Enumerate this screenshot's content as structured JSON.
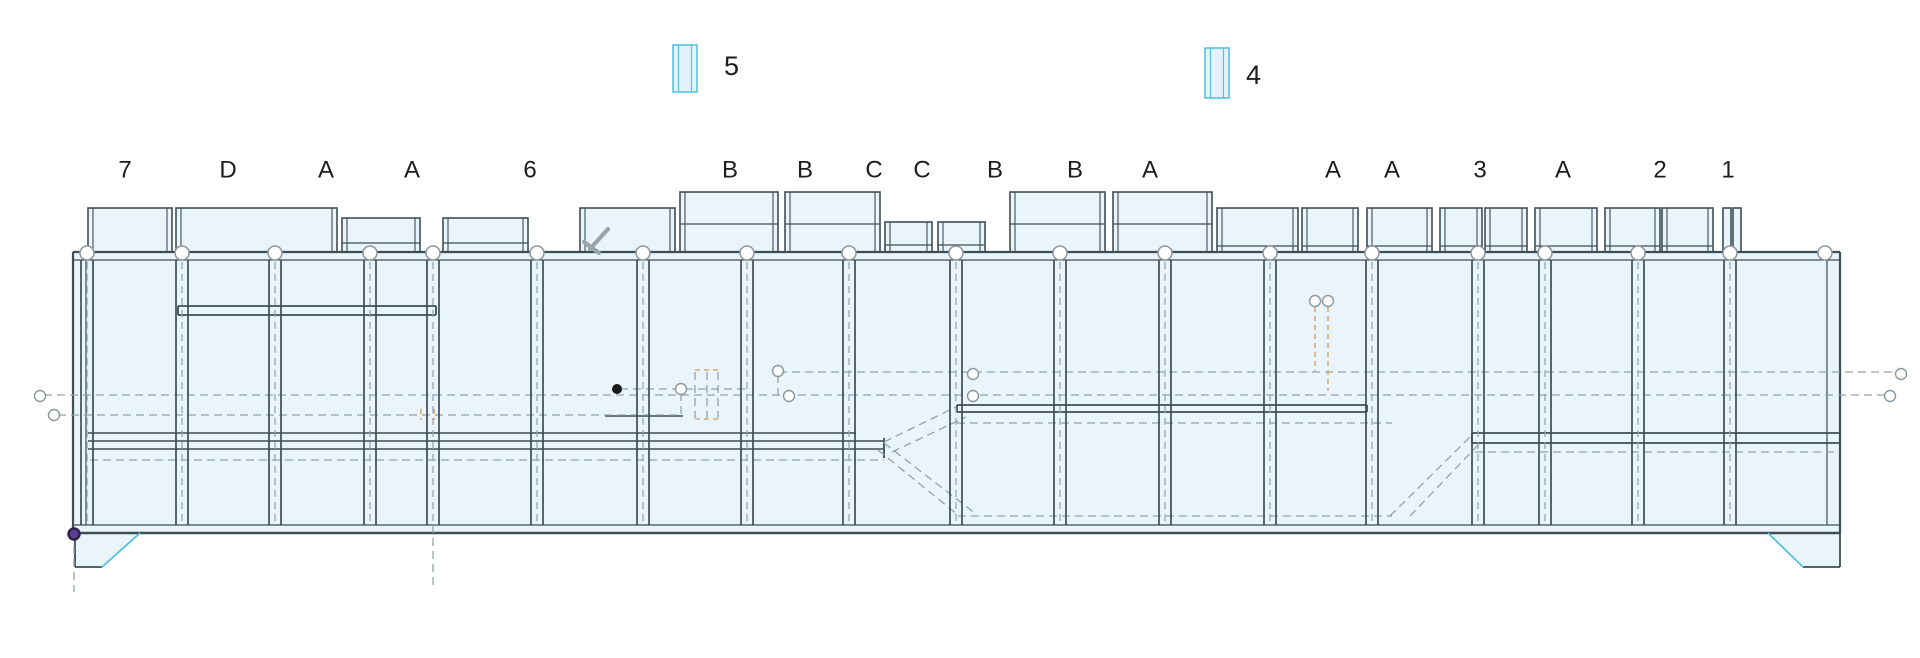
{
  "legend": {
    "items": [
      {
        "label": "5",
        "box": {
          "x": 673,
          "y": 45,
          "w": 24,
          "h": 47
        },
        "label_x": 724,
        "label_y": 68
      },
      {
        "label": "4",
        "box": {
          "x": 1205,
          "y": 48,
          "w": 24,
          "h": 50
        },
        "label_x": 1246,
        "label_y": 77
      }
    ]
  },
  "grid_labels": {
    "y": 171,
    "font_size": 24,
    "items": [
      {
        "text": "7",
        "x": 125
      },
      {
        "text": "D",
        "x": 228
      },
      {
        "text": "A",
        "x": 326
      },
      {
        "text": "A",
        "x": 412
      },
      {
        "text": "6",
        "x": 530
      },
      {
        "text": "B",
        "x": 730
      },
      {
        "text": "B",
        "x": 805
      },
      {
        "text": "C",
        "x": 874
      },
      {
        "text": "C",
        "x": 922
      },
      {
        "text": "B",
        "x": 995
      },
      {
        "text": "B",
        "x": 1075
      },
      {
        "text": "A",
        "x": 1150
      },
      {
        "text": "A",
        "x": 1333
      },
      {
        "text": "A",
        "x": 1392
      },
      {
        "text": "3",
        "x": 1480
      },
      {
        "text": "A",
        "x": 1563
      },
      {
        "text": "2",
        "x": 1660
      },
      {
        "text": "1",
        "x": 1728
      }
    ]
  },
  "colors": {
    "fill": "#e9f4fb",
    "line_dark": "#3f4d57",
    "dash_gray": "#93a2ac",
    "circle_stroke": "#8d979f",
    "cyan": "#57c2de",
    "cyan_fill": "#e3f3f9",
    "orange": "#d49a62",
    "black_dot": "#1b1b1b",
    "purple_fill": "#5a3f8f",
    "purple_ring": "#2a2148",
    "icon_gray": "#9aa4ab",
    "text": "#1d1d1f"
  },
  "drawing": {
    "band": {
      "x1": 73,
      "x2": 1840,
      "top": 252,
      "bottom": 533
    },
    "posts": {
      "xs": [
        87,
        182,
        275,
        370,
        433,
        537,
        643,
        747,
        849,
        956,
        1060,
        1165,
        1270,
        1372,
        1478,
        1545,
        1638,
        1730
      ],
      "y1": 260,
      "y2": 525,
      "half_width": 6
    },
    "top_circles": {
      "xs": [
        87,
        182,
        275,
        370,
        433,
        537,
        643,
        747,
        849,
        956,
        1060,
        1165,
        1270,
        1372,
        1478,
        1545,
        1638,
        1730,
        1825
      ],
      "y": 253,
      "r": 7
    },
    "panels": [
      {
        "x1": 88,
        "x2": 172,
        "top": 208,
        "divider": null
      },
      {
        "x1": 176,
        "x2": 337,
        "top": 208,
        "divider": null
      },
      {
        "x1": 342,
        "x2": 420,
        "top": 218,
        "divider": 243
      },
      {
        "x1": 443,
        "x2": 528,
        "top": 218,
        "divider": 243
      },
      {
        "x1": 580,
        "x2": 675,
        "top": 208,
        "divider": null
      },
      {
        "x1": 680,
        "x2": 778,
        "top": 192,
        "divider": 224
      },
      {
        "x1": 785,
        "x2": 880,
        "top": 192,
        "divider": 224
      },
      {
        "x1": 885,
        "x2": 932,
        "top": 222,
        "divider": 245
      },
      {
        "x1": 938,
        "x2": 985,
        "top": 222,
        "divider": 245
      },
      {
        "x1": 1010,
        "x2": 1105,
        "top": 192,
        "divider": 224
      },
      {
        "x1": 1113,
        "x2": 1212,
        "top": 192,
        "divider": 224
      },
      {
        "x1": 1217,
        "x2": 1298,
        "top": 208,
        "divider": 246
      },
      {
        "x1": 1302,
        "x2": 1358,
        "top": 208,
        "divider": 246
      },
      {
        "x1": 1367,
        "x2": 1432,
        "top": 208,
        "divider": 246
      },
      {
        "x1": 1440,
        "x2": 1482,
        "top": 208,
        "divider": 246
      },
      {
        "x1": 1485,
        "x2": 1527,
        "top": 208,
        "divider": 246
      },
      {
        "x1": 1535,
        "x2": 1597,
        "top": 208,
        "divider": 246
      },
      {
        "x1": 1605,
        "x2": 1660,
        "top": 208,
        "divider": 246
      },
      {
        "x1": 1662,
        "x2": 1713,
        "top": 208,
        "divider": 246
      },
      {
        "x1": 1723,
        "x2": 1731,
        "top": 208,
        "divider": null
      },
      {
        "x1": 1733,
        "x2": 1741,
        "top": 208,
        "divider": null
      }
    ],
    "solid_lines": [
      [
        73,
        252,
        1840,
        252,
        2.2
      ],
      [
        73,
        260,
        1840,
        260,
        1.2
      ],
      [
        73,
        525,
        1840,
        525,
        1.2
      ],
      [
        73,
        533,
        1840,
        533,
        2.4
      ],
      [
        73,
        252,
        73,
        533,
        2.2
      ],
      [
        86,
        260,
        86,
        525,
        1.2
      ],
      [
        1827,
        260,
        1827,
        525,
        1.2
      ],
      [
        1840,
        252,
        1840,
        533,
        2.2
      ],
      [
        178,
        306,
        436,
        306,
        1.8
      ],
      [
        178,
        315,
        436,
        315,
        1.8
      ],
      [
        178,
        306,
        178,
        315,
        1.8
      ],
      [
        436,
        306,
        436,
        315,
        1.8
      ],
      [
        88,
        433,
        856,
        433,
        1.6
      ],
      [
        88,
        441,
        884,
        441,
        1.6
      ],
      [
        88,
        449,
        884,
        449,
        1.6
      ],
      [
        884,
        438,
        884,
        458,
        1.8
      ],
      [
        957,
        405,
        1367,
        405,
        1.8
      ],
      [
        957,
        412,
        1367,
        412,
        1.8
      ],
      [
        957,
        405,
        957,
        412,
        1.8
      ],
      [
        1367,
        405,
        1367,
        412,
        1.8
      ],
      [
        1472,
        433,
        1840,
        433,
        1.8
      ],
      [
        1472,
        443,
        1840,
        443,
        1.8
      ],
      [
        1472,
        433,
        1472,
        443,
        1.8
      ],
      [
        605,
        416,
        683,
        416,
        1.5
      ],
      [
        75,
        533,
        75,
        567,
        1.8
      ],
      [
        75,
        567,
        102,
        567,
        1.8
      ],
      [
        1803,
        567,
        1840,
        567,
        1.8
      ],
      [
        1840,
        533,
        1840,
        567,
        1.8
      ]
    ],
    "cyan_lines": [
      [
        102,
        567,
        140,
        533
      ],
      [
        1768,
        533,
        1803,
        567
      ]
    ],
    "dashed_lines": [
      [
        779,
        372,
        1896,
        372
      ],
      [
        44,
        395,
        1888,
        395
      ],
      [
        58,
        415,
        680,
        415
      ],
      [
        957,
        423,
        1392,
        423
      ],
      [
        1475,
        452,
        1838,
        452
      ],
      [
        90,
        460,
        884,
        460
      ],
      [
        620,
        389,
        745,
        389
      ],
      [
        958,
        516,
        1392,
        516
      ],
      [
        884,
        442,
        956,
        407
      ],
      [
        892,
        452,
        966,
        417
      ],
      [
        884,
        443,
        976,
        514
      ],
      [
        878,
        450,
        958,
        515
      ],
      [
        1390,
        516,
        1471,
        436
      ],
      [
        1410,
        516,
        1479,
        444
      ],
      [
        74,
        533,
        74,
        592
      ],
      [
        433,
        525,
        433,
        588
      ],
      [
        681,
        393,
        681,
        417
      ],
      [
        778,
        375,
        778,
        400
      ],
      [
        695,
        372,
        695,
        418
      ],
      [
        707,
        372,
        707,
        418
      ],
      [
        718,
        372,
        718,
        418
      ]
    ],
    "orange_dashed": [
      [
        695,
        370,
        718,
        370
      ],
      [
        695,
        419,
        718,
        419
      ],
      [
        1315,
        307,
        1315,
        371
      ],
      [
        1328,
        307,
        1328,
        391
      ],
      [
        421,
        409,
        421,
        420
      ],
      [
        434,
        409,
        434,
        420
      ]
    ],
    "small_circles": [
      [
        40,
        396
      ],
      [
        54,
        415
      ],
      [
        681,
        389
      ],
      [
        778,
        371
      ],
      [
        789,
        396
      ],
      [
        973,
        374
      ],
      [
        973,
        396
      ],
      [
        1315,
        301
      ],
      [
        1328,
        301
      ],
      [
        1890,
        396
      ],
      [
        1901,
        374
      ]
    ],
    "small_circle_r": 5.5,
    "black_dot": {
      "x": 617,
      "y": 389,
      "r": 5
    },
    "purple_dot": {
      "x": 74,
      "y": 534,
      "r": 5.5
    },
    "feet": [
      {
        "points": "75,533 140,533 102,567 75,567"
      },
      {
        "points": "1768,533 1840,533 1840,567 1803,567"
      }
    ],
    "clamp_icon": [
      [
        590,
        249,
        608,
        229
      ],
      [
        584,
        242,
        599,
        253
      ]
    ]
  }
}
